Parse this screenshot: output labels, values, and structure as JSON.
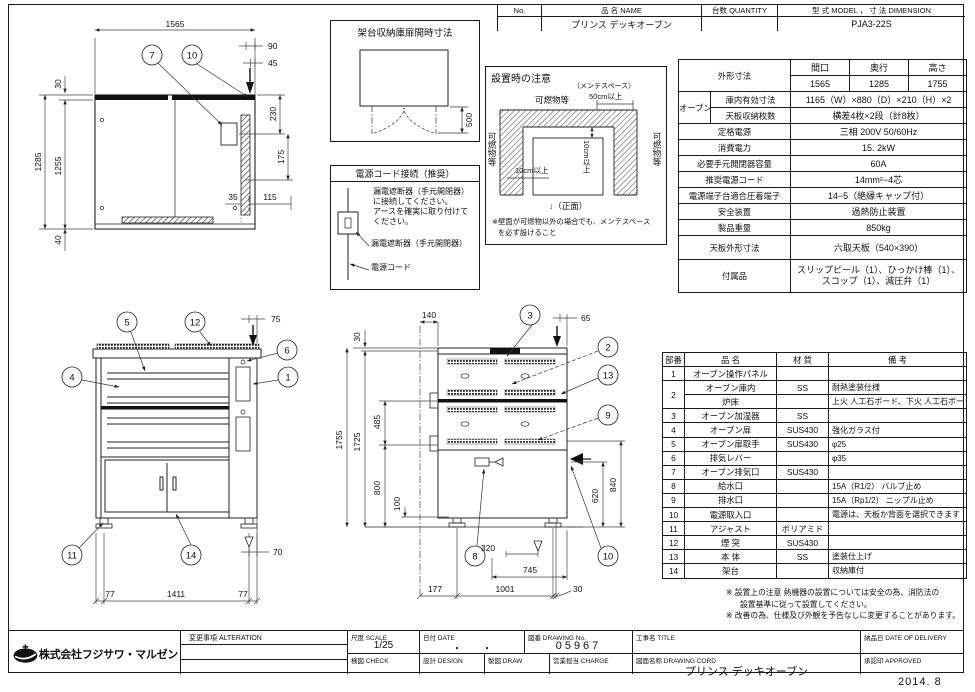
{
  "sheet": {
    "date_stamp": "2014. 8"
  },
  "header_table": {
    "no_label": "No.",
    "name_label": "品 名 NAME",
    "qty_label": "台数 QUANTITY",
    "model_label": "型 式 MODEL ， 寸 法 DIMENSION",
    "name_value": "プリンス デッキオーブン",
    "qty_value": "",
    "model_value": "PJA3-22S"
  },
  "spec_table": {
    "outer": {
      "label": "外形寸法",
      "cols": [
        "間口",
        "奥行",
        "高さ"
      ],
      "vals": [
        "1565",
        "1285",
        "1755"
      ]
    },
    "oven": {
      "label": "オーブン",
      "rows": [
        {
          "label": "庫内有効寸法",
          "value": "1165（W）×880（D）×210（H）×2"
        },
        {
          "label": "天板収納枚数",
          "value": "横差4枚×2段（計8枚）"
        }
      ]
    },
    "rows": [
      {
        "label": "定格電源",
        "value": "三相 200V 50/60Hz",
        "dashed": false,
        "size": "n"
      },
      {
        "label": "消費電力",
        "value": "15. 2kW",
        "dashed": false,
        "size": "n"
      },
      {
        "label": "必要手元開閉器容量",
        "value": "60A",
        "dashed": false,
        "size": "n"
      },
      {
        "label": "推奨電源コード",
        "value": "14mm²−4芯",
        "dashed": true,
        "size": "n"
      },
      {
        "label": "電源端子台適合圧着端子",
        "value": "14−5（絶縁キャップ付）",
        "dashed": true,
        "size": "n"
      },
      {
        "label": "安全装置",
        "value": "過熱防止装置",
        "dashed": false,
        "size": "n"
      },
      {
        "label": "製品重量",
        "value": "850kg",
        "dashed": false,
        "size": "n"
      },
      {
        "label": "天板外形寸法",
        "value": "六取天板（540×390）",
        "dashed": false,
        "size": "tall"
      },
      {
        "label": "付属品",
        "value": "スリップピール（1）、ひっかけ棒（1）、スコップ（1）、減圧弁（1）",
        "dashed": false,
        "size": "taller"
      }
    ]
  },
  "parts_table": {
    "cols": [
      "部番",
      "品 名",
      "材 質",
      "備 考"
    ],
    "rows": [
      [
        "1",
        "オーブン操作パネル",
        "",
        ""
      ],
      [
        "2",
        "オーブン庫内",
        "SS",
        "耐熱塗装仕様"
      ],
      [
        "",
        "炉床",
        "",
        "上火 人工石ボード、下火 人工石ボード"
      ],
      [
        "3",
        "オーブン加湿器",
        "SS",
        ""
      ],
      [
        "4",
        "オーブン扉",
        "SUS430",
        "強化ガラス付"
      ],
      [
        "5",
        "オーブン扉取手",
        "SUS430",
        "φ25"
      ],
      [
        "6",
        "排気レバー",
        "",
        "φ35"
      ],
      [
        "7",
        "オーブン排気口",
        "SUS430",
        ""
      ],
      [
        "8",
        "給水口",
        "",
        "15A（R1/2） バルブ止め"
      ],
      [
        "9",
        "排水口",
        "",
        "15A（Rp1/2） ニップル止め"
      ],
      [
        "10",
        "電源取入口",
        "",
        "電源は、天板か背面を選択できます"
      ],
      [
        "11",
        "アジャスト",
        "ポリアミド",
        ""
      ],
      [
        "12",
        "煙 突",
        "SUS430",
        ""
      ],
      [
        "13",
        "本 体",
        "SS",
        "塗装仕上げ"
      ],
      [
        "14",
        "架台",
        "",
        "収納庫付"
      ]
    ]
  },
  "notes": {
    "line1": "※ 設置上の注意 熱機器の設置については安全の為、消防法の",
    "line2": "設置基準に従って設置してください。",
    "line3": "※ 改善の為、仕様及び外観を予告なしに変更することがあります。"
  },
  "title_block": {
    "alteration_label": "変更事項 ALTERATION",
    "scale_label": "尺度 SCALE",
    "scale_value": "1/25",
    "date_label": "日付 DATE",
    "date_value": "・　　・",
    "dwg_no_label": "図番 DRAWING No.",
    "dwg_no_value": "05967",
    "title_label": "工事名 TITLE",
    "title_value": "",
    "delivery_label": "納品日 DATE OF DELIVERY",
    "delivery_value": "",
    "check_label": "検図 CHECK",
    "design_label": "設計 DESIGN",
    "draw_label": "製図 DRAW",
    "charge_label": "営業担当 CHARGE",
    "dwg_name_label": "図面名称 DRAWING CORD",
    "dwg_name_value": "プリンス デッキオーブン",
    "approved_label": "承認印 APPROVED",
    "company": "株式会社フジサワ・マルゼン"
  },
  "stand_box": {
    "title": "架台収納庫扉開時寸法",
    "dim_500": "500"
  },
  "power_box": {
    "title": "電源コード接続（推奨）",
    "body1": "漏電遮断器（手元開閉器）",
    "body2": "に接続してください。",
    "body3": "アースを確実に取り付けて",
    "body4": "ください。",
    "label_breaker": "漏電遮断器（手元開閉器）",
    "label_cord": "電源コード"
  },
  "install_box": {
    "title": "設置時の注意",
    "maint_space": "（メンテスペース）",
    "dim_50cm": "50cm以上",
    "flammable_top": "可燃物等",
    "flammable_left": "可燃物等",
    "flammable_right": "可燃物等",
    "dim_10cm_h": "10cm以上",
    "dim_10cm_v": "10cm以上",
    "front_label": "↓（正面）",
    "note1": "※壁面が可燃物以外の場合でも、メンテスペース",
    "note2": "を必ず設けること"
  },
  "plan_view": {
    "d_1565": "1565",
    "d_90": "90",
    "d_45": "45",
    "d_30": "30",
    "d_1285": "1285",
    "d_1255": "1255",
    "d_40": "40",
    "d_230": "230",
    "d_175": "175",
    "d_35": "35",
    "d_115": "115",
    "c_7": "7",
    "c_10": "10"
  },
  "front_view": {
    "d_75": "75",
    "d_70": "70",
    "d_77l": "77",
    "d_1411": "1411",
    "d_77r": "77",
    "c_5": "5",
    "c_12": "12",
    "c_6": "6",
    "c_4": "4",
    "c_1": "1",
    "c_11": "11",
    "c_14": "14"
  },
  "side_view": {
    "d_30": "30",
    "d_140": "140",
    "d_65": "65",
    "d_1755": "1755",
    "d_1725": "1725",
    "d_485": "485",
    "d_800": "800",
    "d_100": "100",
    "d_620": "620",
    "d_840": "840",
    "d_320": "320",
    "d_745": "745",
    "d_177": "177",
    "d_1001": "1001",
    "d_30b": "30",
    "c_3": "3",
    "c_2": "2",
    "c_13": "13",
    "c_9": "9",
    "c_8": "8",
    "c_10": "10"
  }
}
